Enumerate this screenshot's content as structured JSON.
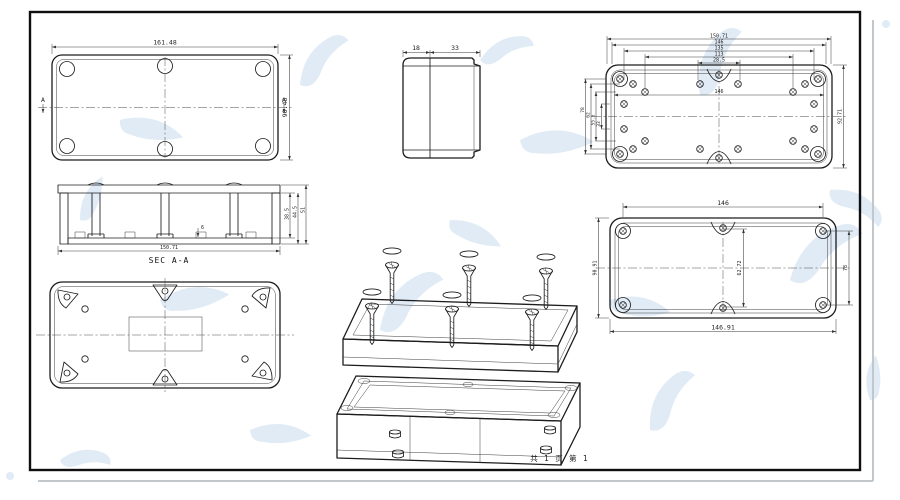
{
  "page": {
    "footer": "共 1 页  第 1"
  },
  "colors": {
    "line": "#1c1c1c",
    "dim": "#3a3a3a",
    "watermark": "#dbe8f5",
    "frame": "#0f0f0f",
    "shadow": "#c2c7cc"
  },
  "views": {
    "lid_top": {
      "dim_width": "161.48",
      "dim_height": "90.48",
      "section_left": "A",
      "section_right": "A"
    },
    "side": {
      "dim_lid": "18",
      "dim_base": "33"
    },
    "base_inside": {
      "dim_overall": "150.71",
      "dim_outer": "146",
      "dim_holes_a": "135",
      "dim_holes_b": "113",
      "dim_center": "28.5",
      "dim_inner": "146",
      "dim_height": "92.71",
      "dim_left_a": "78",
      "dim_left_b": "62",
      "dim_left_c": "55.5",
      "dim_left_d": "33"
    },
    "section": {
      "label": "SEC A-A",
      "dim_width": "150.71",
      "dim_depth_a": "38.5",
      "dim_depth_b": "44.5",
      "dim_depth_c": "51",
      "dim_rib": "6"
    },
    "lid_inside": {
      "dim_top": "146",
      "dim_bottom": "146.91",
      "dim_left": "90.91",
      "dim_right": "78",
      "dim_center": "62.72"
    }
  }
}
